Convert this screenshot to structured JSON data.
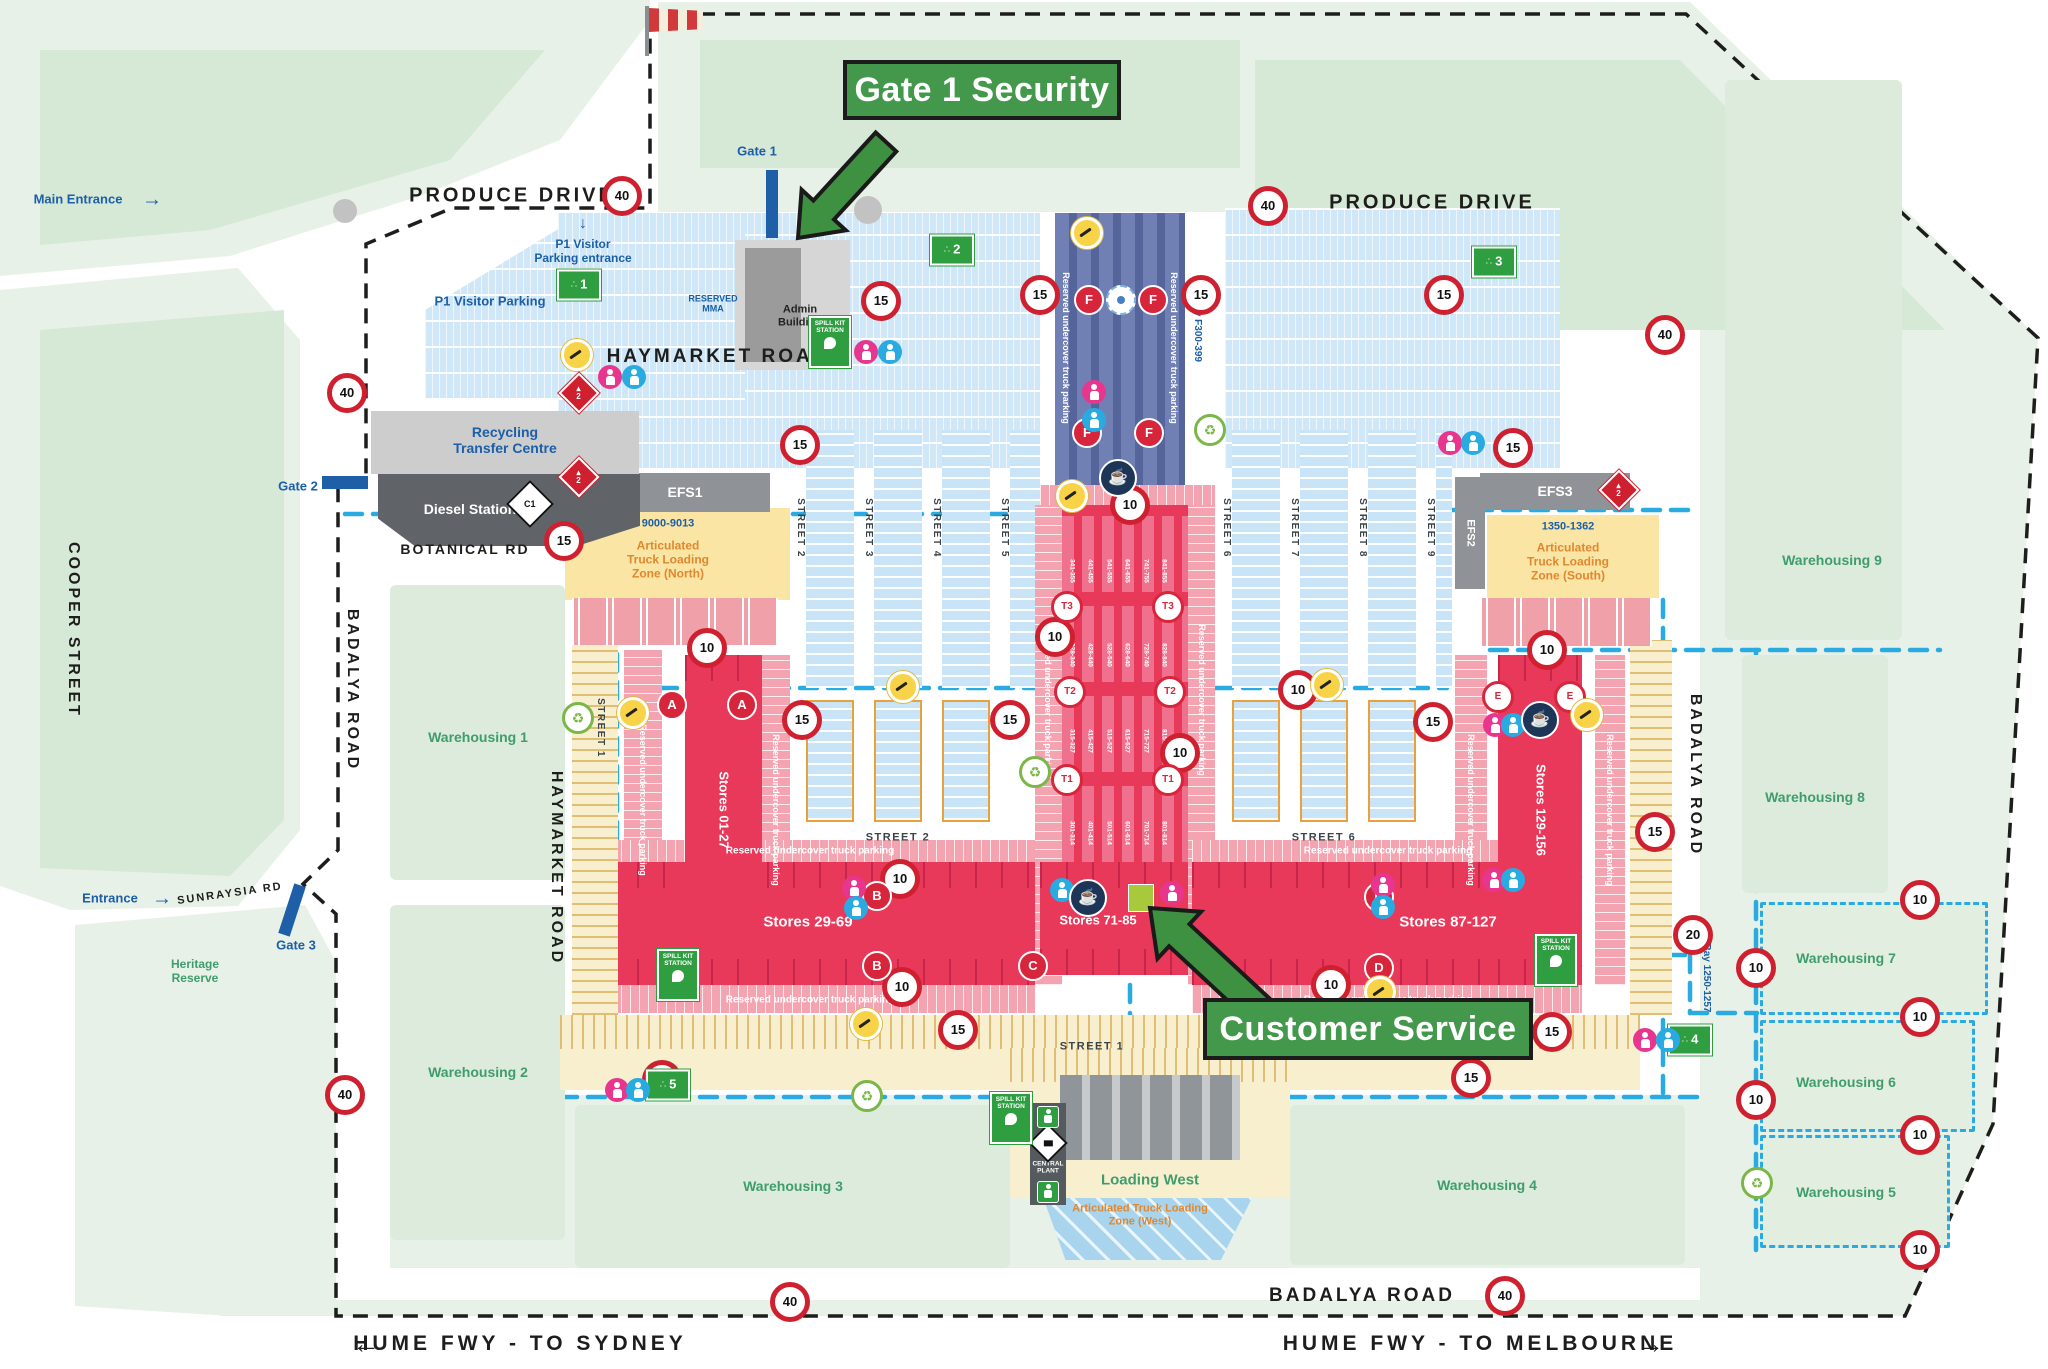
{
  "callouts": {
    "gate1_security": "Gate 1 Security",
    "customer_service": "Customer Service"
  },
  "strings": {
    "reserved": "Reserved undercover truck parking",
    "spill_kit": "SPILL KIT\nSTATION",
    "central_plant": "CENTRAL\nPLANT"
  },
  "labels": [
    [
      "PRODUCE DRIVE",
      512,
      196,
      "l-road"
    ],
    [
      "PRODUCE DRIVE",
      1432,
      203,
      "l-road"
    ],
    [
      "HAYMARKET ROAD",
      718,
      357,
      "l-road",
      19
    ],
    [
      "BOTANICAL RD",
      465,
      549,
      "l-roadm"
    ],
    [
      "BADALYA ROAD",
      1362,
      1296,
      "l-road",
      19
    ],
    [
      "COOPER STREET",
      73,
      630,
      "l-road",
      16,
      90
    ],
    [
      "BADALYA ROAD",
      352,
      690,
      "l-road",
      16,
      90
    ],
    [
      "HAYMARKET ROAD",
      556,
      868,
      "l-road",
      16,
      90
    ],
    [
      "BADALYA ROAD",
      1695,
      775,
      "l-road",
      16,
      90
    ],
    [
      "SUNRAYSIA RD",
      230,
      894,
      "l-roadm",
      11,
      -8
    ],
    [
      "STREET 2",
      800,
      528,
      "l-street",
      null,
      90
    ],
    [
      "STREET 3",
      868,
      528,
      "l-street",
      null,
      90
    ],
    [
      "STREET 4",
      936,
      528,
      "l-street",
      null,
      90
    ],
    [
      "STREET 5",
      1004,
      528,
      "l-street",
      null,
      90
    ],
    [
      "STREET 6",
      1226,
      528,
      "l-street",
      null,
      90
    ],
    [
      "STREET 7",
      1294,
      528,
      "l-street",
      null,
      90
    ],
    [
      "STREET 8",
      1362,
      528,
      "l-street",
      null,
      90
    ],
    [
      "STREET 9",
      1430,
      528,
      "l-street",
      null,
      90
    ],
    [
      "STREET 1",
      600,
      728,
      "l-street",
      null,
      90
    ],
    [
      "STREET 2",
      898,
      838,
      "l-street",
      11
    ],
    [
      "STREET 6",
      1324,
      838,
      "l-street",
      11
    ],
    [
      "STREET 1",
      1092,
      1047,
      "l-street",
      11
    ],
    [
      "←",
      368,
      1344,
      "l-fwy",
      28
    ],
    [
      "HUME FWY - TO SYDNEY",
      520,
      1344,
      "l-fwy"
    ],
    [
      "HUME FWY - TO MELBOURNE",
      1480,
      1344,
      "l-fwy"
    ],
    [
      "→",
      1652,
      1344,
      "l-fwy",
      28
    ],
    [
      "Main Entrance",
      78,
      200,
      "l-blue"
    ],
    [
      "→",
      152,
      200,
      "l-blue",
      20
    ],
    [
      "Entrance",
      110,
      899,
      "l-blue"
    ],
    [
      "→",
      162,
      899,
      "l-blue",
      20
    ],
    [
      "Gate 1",
      757,
      152,
      "l-blue"
    ],
    [
      "Gate 2",
      298,
      487,
      "l-blue"
    ],
    [
      "Gate 3",
      296,
      946,
      "l-blue"
    ],
    [
      "↓",
      583,
      224,
      "l-blue",
      16
    ],
    [
      "P1 Visitor\nParking entrance",
      583,
      252,
      "l-blue",
      12
    ],
    [
      "P1 Visitor Parking",
      490,
      302,
      "l-blue"
    ],
    [
      "RESERVED\nMMA",
      713,
      304,
      "l-blue",
      9
    ],
    [
      "Recycling\nTransfer Centre",
      505,
      440,
      "l-blue",
      14
    ],
    [
      "9000-9013",
      668,
      524,
      "l-blue",
      11
    ],
    [
      "1350-1362",
      1568,
      527,
      "l-blue",
      11
    ],
    [
      "Bay F300-399",
      1197,
      330,
      "l-bay",
      10,
      90
    ],
    [
      "Bay 1250-1257",
      1706,
      978,
      "l-bay",
      10,
      90
    ],
    [
      "Warehousing 1",
      478,
      737,
      "l-green"
    ],
    [
      "Warehousing 2",
      478,
      1072,
      "l-green"
    ],
    [
      "Warehousing 3",
      793,
      1186,
      "l-green"
    ],
    [
      "Warehousing 4",
      1487,
      1185,
      "l-green"
    ],
    [
      "Warehousing 5",
      1846,
      1192,
      "l-green"
    ],
    [
      "Warehousing 6",
      1846,
      1082,
      "l-green"
    ],
    [
      "Warehousing 7",
      1846,
      958,
      "l-green"
    ],
    [
      "Warehousing 8",
      1815,
      797,
      "l-green"
    ],
    [
      "Warehousing 9",
      1832,
      560,
      "l-green"
    ],
    [
      "Heritage\nReserve",
      195,
      972,
      "l-green",
      12
    ],
    [
      "Loading West",
      1150,
      1180,
      "l-green",
      15
    ],
    [
      "Articulated\nTruck Loading\nZone (North)",
      668,
      560,
      "l-orange"
    ],
    [
      "Articulated\nTruck Loading\nZone (South)",
      1568,
      562,
      "l-orange"
    ],
    [
      "Articulated Truck Loading\nZone (West)",
      1140,
      1215,
      "l-orange",
      11
    ],
    [
      "EFS1",
      685,
      492,
      "l-white"
    ],
    [
      "EFS2",
      1470,
      533,
      "l-white",
      11,
      90
    ],
    [
      "EFS3",
      1555,
      491,
      "l-white"
    ],
    [
      "Diesel Station",
      470,
      509,
      "l-white"
    ],
    [
      "Stores 01-27",
      723,
      810,
      "l-white",
      13,
      90
    ],
    [
      "Stores 29-69",
      808,
      922,
      "l-white",
      15
    ],
    [
      "Stores 71-85",
      1098,
      921,
      "l-white",
      13
    ],
    [
      "Stores 87-127",
      1448,
      922,
      "l-white",
      15
    ],
    [
      "Stores 129-156",
      1540,
      810,
      "l-white",
      13,
      90
    ],
    [
      "Admin\nBuilding",
      800,
      316,
      "l-black"
    ],
    [
      "CENTRAL\nPLANT",
      1048,
      1168,
      "l-white",
      6.5
    ]
  ],
  "reserved_positions": {
    "h": [
      [
        810,
        851
      ],
      [
        1388,
        851
      ],
      [
        810,
        1000
      ],
      [
        1388,
        1000
      ]
    ],
    "v": [
      [
        643,
        800
      ],
      [
        776,
        810
      ],
      [
        1048,
        700
      ],
      [
        1202,
        700
      ],
      [
        1471,
        810
      ],
      [
        1610,
        810
      ],
      [
        1066,
        348
      ],
      [
        1174,
        348
      ]
    ]
  },
  "spill_kit_positions": [
    [
      830,
      342
    ],
    [
      678,
      975
    ],
    [
      1556,
      960
    ],
    [
      1011,
      1118
    ]
  ],
  "speed_signs": {
    "40": [
      [
        622,
        196
      ],
      [
        1268,
        206
      ],
      [
        347,
        393
      ],
      [
        1665,
        335
      ],
      [
        345,
        1095
      ],
      [
        1505,
        1296
      ],
      [
        790,
        1302
      ]
    ],
    "15": [
      [
        881,
        301
      ],
      [
        564,
        541
      ],
      [
        1040,
        295
      ],
      [
        1201,
        295
      ],
      [
        1444,
        295
      ],
      [
        800,
        445
      ],
      [
        1513,
        448
      ],
      [
        802,
        720
      ],
      [
        1010,
        720
      ],
      [
        1433,
        722
      ],
      [
        958,
        1030
      ],
      [
        1552,
        1032
      ],
      [
        1471,
        1078
      ],
      [
        662,
        1080
      ],
      [
        1655,
        832
      ]
    ],
    "10": [
      [
        707,
        648
      ],
      [
        1130,
        505
      ],
      [
        1055,
        637
      ],
      [
        900,
        879
      ],
      [
        902,
        987
      ],
      [
        1180,
        753
      ],
      [
        1298,
        690
      ],
      [
        1547,
        650
      ],
      [
        1331,
        985
      ],
      [
        1756,
        968
      ],
      [
        1920,
        900
      ],
      [
        1920,
        1017
      ],
      [
        1756,
        1100
      ],
      [
        1920,
        1135
      ],
      [
        1920,
        1250
      ]
    ],
    "20": [
      [
        1693,
        935
      ]
    ]
  },
  "assembly_points": [
    [
      "1",
      579,
      285
    ],
    [
      "2",
      952,
      250
    ],
    [
      "3",
      1494,
      262
    ],
    [
      "4",
      1690,
      1040
    ],
    [
      "5",
      668,
      1085
    ]
  ],
  "letter_markers": {
    "solid": [
      [
        "A",
        672,
        705
      ],
      [
        "A",
        742,
        705
      ],
      [
        "B",
        877,
        896
      ],
      [
        "B",
        877,
        966
      ],
      [
        "C",
        1033,
        966
      ],
      [
        "D",
        1379,
        897
      ],
      [
        "D",
        1379,
        968
      ],
      [
        "F",
        1089,
        300
      ],
      [
        "F",
        1153,
        300
      ],
      [
        "F",
        1087,
        433
      ],
      [
        "F",
        1149,
        433
      ]
    ],
    "outline": [
      [
        "T3",
        1067,
        607
      ],
      [
        "T3",
        1168,
        607
      ],
      [
        "T2",
        1070,
        692
      ],
      [
        "T2",
        1170,
        692
      ],
      [
        "T1",
        1067,
        780
      ],
      [
        "T1",
        1168,
        780
      ],
      [
        "E",
        1498,
        697
      ],
      [
        "E",
        1570,
        697
      ]
    ]
  },
  "gates": [
    {
      "label": "Gate 1",
      "bar": [
        766,
        170,
        12,
        68,
        0
      ]
    },
    {
      "label": "Gate 2",
      "bar": [
        322,
        476,
        46,
        13,
        0
      ]
    },
    {
      "label": "Gate 3",
      "bar": [
        286,
        884,
        12,
        52,
        18
      ]
    }
  ],
  "icons": {
    "toilets": [
      [
        866,
        352,
        "f"
      ],
      [
        890,
        352,
        "m"
      ],
      [
        610,
        377,
        "f"
      ],
      [
        634,
        377,
        "m"
      ],
      [
        1450,
        443,
        "f"
      ],
      [
        1473,
        443,
        "m"
      ],
      [
        1094,
        392,
        "f"
      ],
      [
        1094,
        420,
        "m"
      ],
      [
        854,
        888,
        "f"
      ],
      [
        856,
        908,
        "m"
      ],
      [
        1062,
        890,
        "m"
      ],
      [
        1172,
        893,
        "f"
      ],
      [
        1495,
        725,
        "f"
      ],
      [
        1513,
        725,
        "m"
      ],
      [
        1383,
        885,
        "f"
      ],
      [
        1383,
        907,
        "m"
      ],
      [
        1494,
        880,
        "f"
      ],
      [
        1513,
        880,
        "m"
      ],
      [
        617,
        1090,
        "f"
      ],
      [
        638,
        1090,
        "m"
      ],
      [
        1645,
        1040,
        "f"
      ],
      [
        1668,
        1040,
        "m"
      ]
    ],
    "coffee": [
      [
        1118,
        478
      ],
      [
        1088,
        898
      ],
      [
        1540,
        720
      ]
    ],
    "recycle": [
      [
        578,
        718
      ],
      [
        1210,
        430
      ],
      [
        1035,
        772
      ],
      [
        1757,
        1183
      ],
      [
        867,
        1096
      ]
    ],
    "smoking": [
      [
        577,
        355
      ],
      [
        1087,
        233
      ],
      [
        1072,
        496
      ],
      [
        903,
        687
      ],
      [
        633,
        713
      ],
      [
        866,
        1024
      ],
      [
        1380,
        992
      ],
      [
        1327,
        685
      ],
      [
        1587,
        715
      ]
    ],
    "flammable": [
      [
        579,
        393
      ],
      [
        579,
        477
      ],
      [
        1619,
        490
      ]
    ],
    "hazard_c1": [
      [
        530,
        504
      ]
    ],
    "central_plant_diamond": [
      [
        1048,
        1143
      ]
    ],
    "safety_shower": [
      [
        1048,
        1117
      ],
      [
        1048,
        1192
      ]
    ],
    "roundabouts": [
      [
        345,
        211,
        12
      ],
      [
        868,
        210,
        14
      ]
    ],
    "logo": [
      [
        1121,
        300
      ]
    ]
  },
  "spine_bays": {
    "x_start": 1072,
    "x_step": 18.4,
    "rows": [
      {
        "y": 571,
        "v": [
          "341-355",
          "441-455",
          "541-555",
          "641-655",
          "741-755",
          "841-855"
        ]
      },
      {
        "y": 655,
        "v": [
          "328-340",
          "428-440",
          "528-540",
          "628-640",
          "728-740",
          "828-840"
        ]
      },
      {
        "y": 741,
        "v": [
          "315-327",
          "415-427",
          "515-527",
          "615-627",
          "715-727",
          "815-827"
        ]
      },
      {
        "y": 833,
        "v": [
          "301-314",
          "401-414",
          "501-514",
          "601-614",
          "701-714",
          "801-814"
        ]
      }
    ]
  },
  "zones": [
    [
      "greenInner",
      390,
      585,
      175,
      295,
      "warehousing-1-block"
    ],
    [
      "greenInner",
      390,
      905,
      175,
      335,
      "warehousing-2-block"
    ],
    [
      "greenInner",
      575,
      1105,
      435,
      163,
      "warehousing-3-block"
    ],
    [
      "greenInner",
      1290,
      1105,
      395,
      160,
      "warehousing-4-block"
    ],
    [
      "greenInner",
      1725,
      80,
      177,
      560,
      "warehousing-9-block"
    ],
    [
      "greenInner",
      1742,
      655,
      146,
      238,
      "warehousing-8-block"
    ],
    [
      "wDash",
      1760,
      902,
      228,
      113,
      "warehousing-7-block"
    ],
    [
      "wDash",
      1760,
      1020,
      215,
      112,
      "warehousing-6-block"
    ],
    [
      "wDash",
      1760,
      1135,
      190,
      113,
      "warehousing-5-block"
    ],
    [
      "parkN",
      558,
      213,
      482,
      257,
      "north-parking-west"
    ],
    [
      "parkN",
      1225,
      208,
      335,
      262,
      "north-parking-east"
    ],
    [
      "parkN p1clip",
      425,
      228,
      320,
      172,
      "p1-visitor-parking-area"
    ],
    [
      "parkCol",
      806,
      430,
      48,
      258,
      "street-2-parking"
    ],
    [
      "parkCol",
      874,
      430,
      48,
      258,
      "street-3-parking"
    ],
    [
      "parkCol",
      942,
      430,
      48,
      258,
      "street-4-parking"
    ],
    [
      "parkCol",
      1010,
      430,
      30,
      258,
      "street-5-parking"
    ],
    [
      "parkCol",
      1232,
      430,
      48,
      258,
      "street-6-parking"
    ],
    [
      "parkCol",
      1300,
      430,
      48,
      258,
      "street-7-parking"
    ],
    [
      "parkCol",
      1368,
      430,
      48,
      258,
      "street-8-parking"
    ],
    [
      "parkCol",
      1436,
      430,
      16,
      258,
      "street-9-parking"
    ],
    [
      "parkCol orangeB",
      806,
      700,
      48,
      122,
      "south-parking-block"
    ],
    [
      "parkCol orangeB",
      874,
      700,
      48,
      122,
      "south-parking-block"
    ],
    [
      "parkCol orangeB",
      942,
      700,
      48,
      122,
      "south-parking-block"
    ],
    [
      "parkCol orangeB",
      1232,
      700,
      48,
      122,
      "south-parking-block"
    ],
    [
      "parkCol orangeB",
      1300,
      700,
      48,
      122,
      "south-parking-block"
    ],
    [
      "parkCol orangeB",
      1368,
      700,
      48,
      122,
      "south-parking-block"
    ],
    [
      "spineDark",
      1055,
      213,
      130,
      274,
      "reserved-truck-parking-north"
    ],
    [
      "pinkH",
      1040,
      485,
      175,
      20,
      "spine-cap"
    ],
    [
      "pinkV",
      1035,
      505,
      27,
      480,
      "reserved-strip"
    ],
    [
      "pinkV",
      1188,
      505,
      27,
      480,
      "reserved-strip"
    ],
    [
      "spineRed",
      1062,
      505,
      126,
      357,
      "central-market-spine"
    ],
    [
      "pinkV",
      624,
      650,
      38,
      350,
      "reserved-strip"
    ],
    [
      "pinkV",
      762,
      655,
      28,
      330,
      "reserved-strip"
    ],
    [
      "pinkV",
      1455,
      655,
      32,
      330,
      "reserved-strip"
    ],
    [
      "pinkV",
      1595,
      655,
      30,
      330,
      "reserved-strip"
    ],
    [
      "pinkH",
      585,
      840,
      450,
      22,
      "reserved-strip"
    ],
    [
      "pinkH",
      1192,
      840,
      390,
      22,
      "reserved-strip"
    ],
    [
      "pinkH",
      585,
      985,
      450,
      28,
      "reserved-strip"
    ],
    [
      "pinkH",
      1192,
      985,
      390,
      28,
      "reserved-strip"
    ],
    [
      "storeRed",
      585,
      862,
      450,
      123,
      "stores-29-69-block"
    ],
    [
      "storeRed",
      1040,
      862,
      148,
      113,
      "stores-71-85-block"
    ],
    [
      "storeRed",
      1192,
      862,
      390,
      123,
      "stores-87-127-block"
    ],
    [
      "storeRed",
      685,
      655,
      77,
      330,
      "stores-01-27-block"
    ],
    [
      "storeRed",
      1498,
      655,
      84,
      330,
      "stores-129-156-block"
    ],
    [
      "lime",
      1128,
      884,
      26,
      28,
      "customer-service-office"
    ],
    [
      "yellowV",
      572,
      640,
      46,
      375,
      "street-1-west"
    ],
    [
      "yellowV",
      1630,
      640,
      42,
      375,
      "street-1-east"
    ],
    [
      "yellowH",
      560,
      1015,
      1080,
      75,
      "street-1-south"
    ],
    [
      "atlzY",
      565,
      508,
      225,
      92,
      "atlz-north"
    ],
    [
      "atlzR",
      572,
      598,
      206,
      47,
      "atlz-north-docks"
    ],
    [
      "atlzY",
      1487,
      515,
      172,
      83,
      "atlz-south"
    ],
    [
      "atlzR",
      1480,
      598,
      172,
      48,
      "atlz-south-docks"
    ],
    [
      "yellowH",
      1010,
      1048,
      280,
      150,
      "loading-west-area"
    ],
    [
      "dockG",
      1060,
      1075,
      180,
      85,
      "loading-west-docks"
    ],
    [
      "blueDiag westclip",
      1030,
      1198,
      222,
      62,
      "atlz-west"
    ],
    [
      "cpStrip",
      1030,
      1103,
      36,
      102,
      "central-plant-strip"
    ],
    [
      "efs",
      600,
      473,
      170,
      39,
      "efs1-block"
    ],
    [
      "efs",
      1455,
      477,
      30,
      112,
      "efs2-block"
    ],
    [
      "efs",
      1480,
      473,
      150,
      37,
      "efs3-block"
    ],
    [
      "gray1",
      371,
      411,
      268,
      63,
      "recycling-transfer-centre-block"
    ],
    [
      "diesel",
      378,
      474,
      262,
      72,
      "diesel-station-block"
    ],
    [
      "admL",
      735,
      240,
      115,
      130,
      "admin-building-grounds"
    ],
    [
      "admD",
      745,
      248,
      56,
      114,
      "admin-building"
    ]
  ]
}
